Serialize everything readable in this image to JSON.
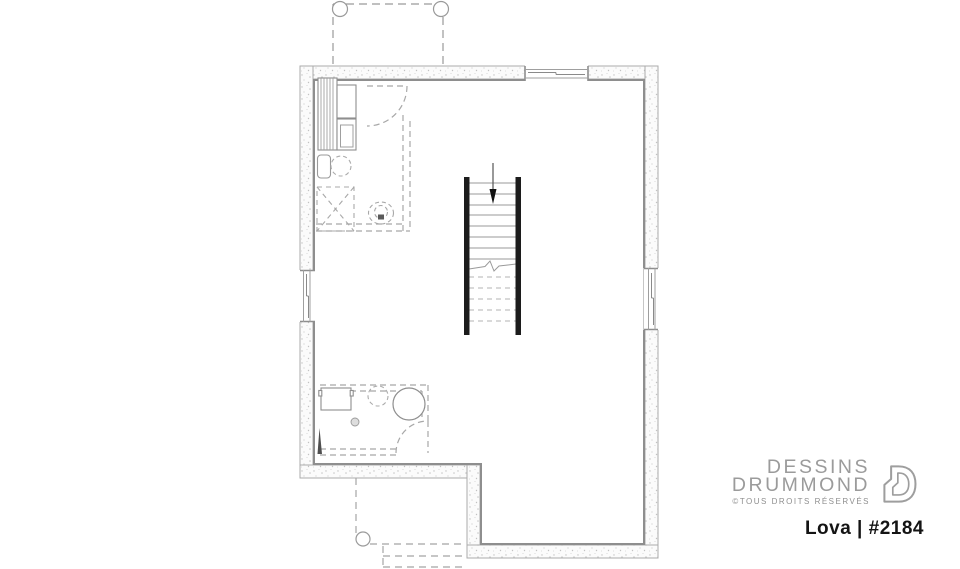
{
  "logo": {
    "line1": "DESSINS",
    "line2": "DRUMMOND",
    "rights": "©TOUS DROITS RÉSERVÉS",
    "mark_icon": "drummond-d-logo"
  },
  "plan_label": {
    "name": "Lova",
    "separator": "|",
    "number": "#2184",
    "display": "Lova | #2184"
  },
  "drawing": {
    "type": "basement-floor-plan",
    "elements": [
      "concrete-exterior-walls",
      "top-porch-posts-dashed",
      "top-wall-window",
      "left-wall-window",
      "right-wall-window",
      "central-staircase-with-down-arrow",
      "future-bathroom-dashed-partitions",
      "shower-dashed",
      "toilet-dashed",
      "laundry-tub",
      "mechanical-shelving",
      "furnace-boxes",
      "laundry-room-dashed",
      "washer",
      "water-heater",
      "floor-drain",
      "door-swings-dashed",
      "rear-steps-dashed"
    ]
  },
  "colors": {
    "line_gray": "#9a9a9a",
    "inner_wall_line": "#8e8e8e",
    "wall_fill": "#fbfbfb",
    "stair_wall_black": "#1c1c1c",
    "dashed_gray": "#a8a8a8",
    "logo_gray": "#9b9b9b",
    "label_black": "#141414"
  }
}
